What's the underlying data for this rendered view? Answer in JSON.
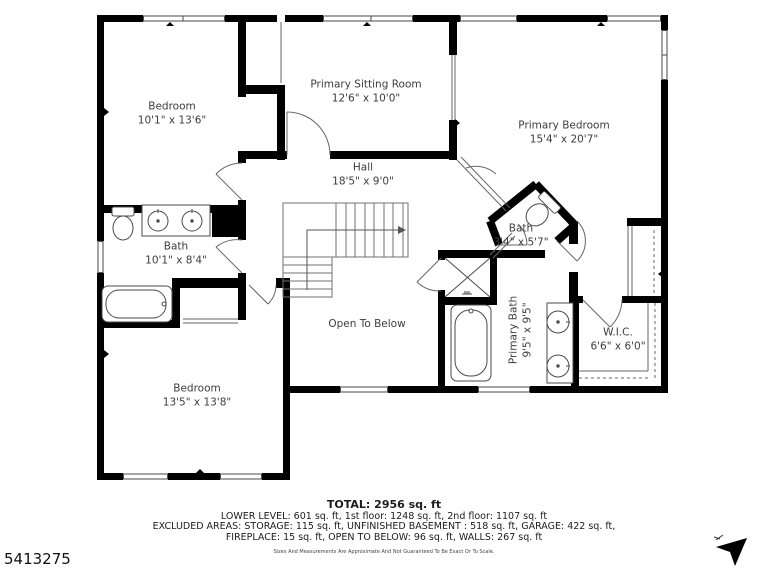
{
  "floorplan": {
    "rooms": [
      {
        "id": "bedroom-1",
        "name": "Bedroom",
        "dims": "10'1\" x 13'6\""
      },
      {
        "id": "primary-sitting-room",
        "name": "Primary Sitting Room",
        "dims": "12'6\" x 10'0\""
      },
      {
        "id": "primary-bedroom",
        "name": "Primary Bedroom",
        "dims": "15'4\" x 20'7\""
      },
      {
        "id": "hall",
        "name": "Hall",
        "dims": "18'5\" x 9'0\""
      },
      {
        "id": "bath",
        "name": "Bath",
        "dims": "10'1\" x 8'4\""
      },
      {
        "id": "bath-angled",
        "name": "Bath",
        "dims": "3'4\" x 5'7\""
      },
      {
        "id": "open-to-below",
        "name": "Open To Below",
        "dims": ""
      },
      {
        "id": "primary-bath",
        "name": "Primary Bath",
        "dims": "9'5\" x 9'5\""
      },
      {
        "id": "wic",
        "name": "W.I.C.",
        "dims": "6'6\" x 6'0\""
      },
      {
        "id": "bedroom-2",
        "name": "Bedroom",
        "dims": "13'5\" x 13'8\""
      }
    ],
    "fixtures": [
      "toilet",
      "vanity-double-sink",
      "bathtub",
      "shower",
      "toilet",
      "bathtub",
      "vanity-double-sink"
    ],
    "stairs_direction": "up"
  },
  "footer": {
    "total": "TOTAL: 2956 sq. ft",
    "levels": "LOWER LEVEL: 601 sq. ft, 1st floor: 1248 sq. ft, 2nd floor: 1107 sq. ft",
    "excluded": "EXCLUDED AREAS: STORAGE: 115 sq. ft, UNFINISHED BASEMENT : 518 sq. ft, GARAGE: 422 sq. ft,",
    "excluded2": "FIREPLACE: 15 sq. ft, OPEN TO BELOW: 96 sq. ft, WALLS: 267 sq. ft",
    "disclaimer": "Sizes And Measurements Are Approximate And Not Guaranteed To Be Exact Or To Scale."
  },
  "watermark": {
    "listing_id": "5413275"
  },
  "colors": {
    "wall": "#000000",
    "label_text": "#3d3d3d",
    "footer_text": "#1c1c1c",
    "thin_line": "#4a4a4a"
  }
}
